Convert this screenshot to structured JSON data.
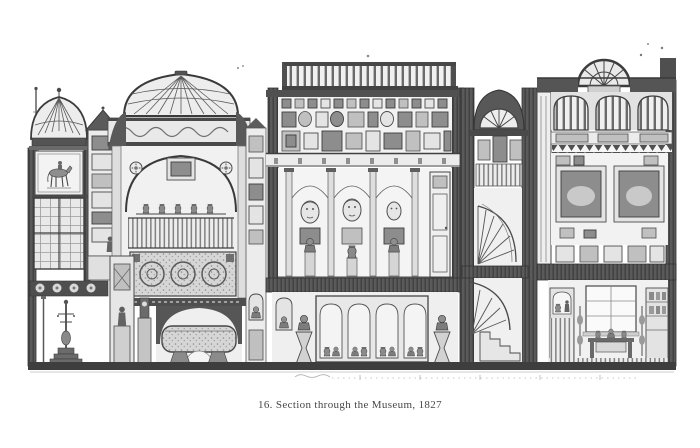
{
  "figure": {
    "plate_number": "16.",
    "title": "Section through the Museum",
    "year": "1827",
    "caption": "16. Section through the Museum, 1827"
  },
  "colors": {
    "paper": "#ffffff",
    "ink_dark": "#3d3d3d",
    "ink_mid": "#7a7a7a",
    "ink_light": "#cfcfcf"
  }
}
